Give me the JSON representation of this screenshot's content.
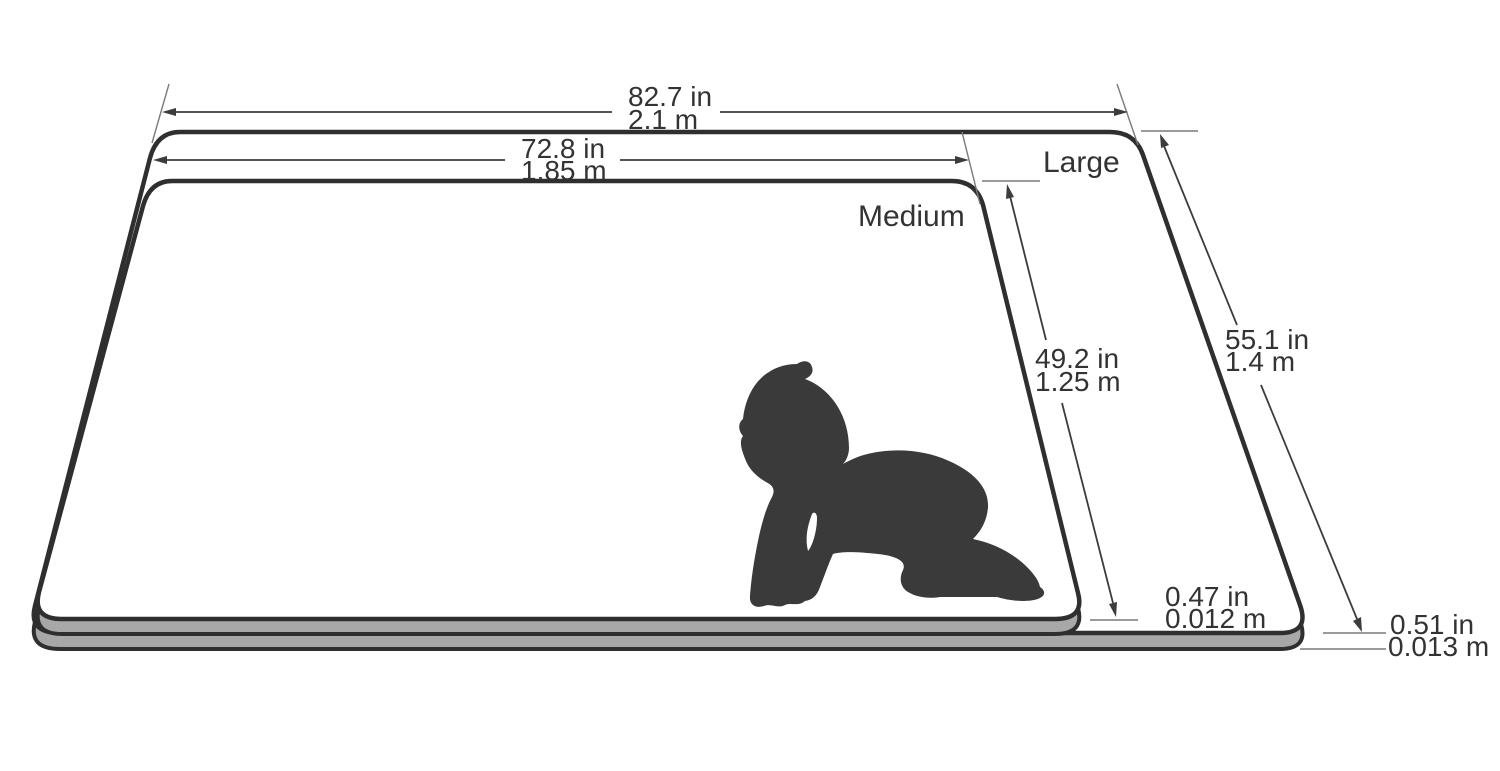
{
  "diagram": {
    "labels": {
      "large": "Large",
      "medium": "Medium"
    },
    "dimensions": {
      "large_width": {
        "in": "82.7 in",
        "m": "2.1 m"
      },
      "medium_width": {
        "in": "72.8 in",
        "m": "1.85 m"
      },
      "medium_depth": {
        "in": "49.2 in",
        "m": "1.25 m"
      },
      "large_depth": {
        "in": "55.1 in",
        "m": "1.4 m"
      },
      "medium_thickness": {
        "in": "0.47 in",
        "m": "0.012 m"
      },
      "large_thickness": {
        "in": "0.51 in",
        "m": "0.013 m"
      }
    },
    "colors": {
      "background": "#ffffff",
      "mat_surface": "#ffffff",
      "mat_side": "#a8a8a8",
      "outline": "#2f2f2f",
      "dimension_line": "#3c3c3c",
      "extension_line": "#7a7a7a",
      "silhouette": "#3a3a3a",
      "text": "#333333"
    }
  }
}
